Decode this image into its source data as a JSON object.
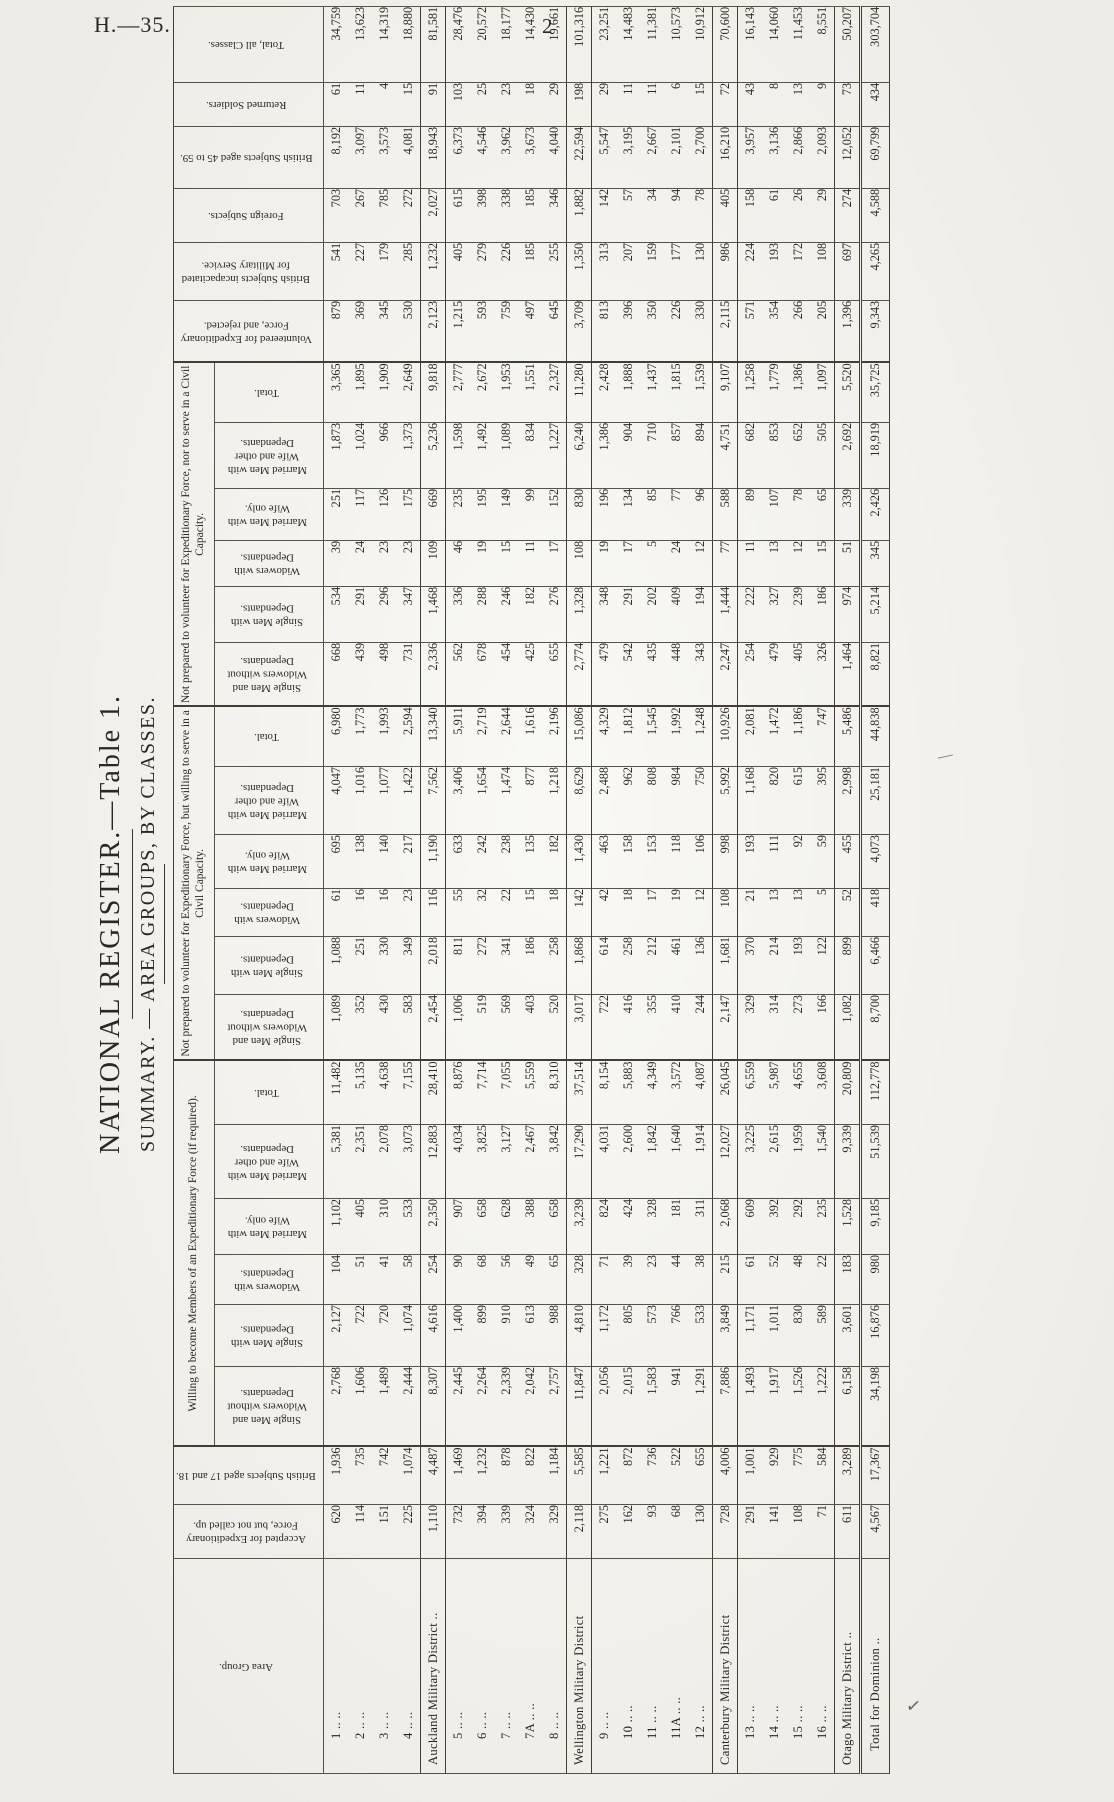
{
  "page": {
    "doc_code": "H.—35.",
    "page_number": "2",
    "ink_marks": [
      "—",
      "✓"
    ]
  },
  "title": {
    "main": "NATIONAL REGISTER.—Table 1.",
    "sub": "SUMMARY. — AREA GROUPS, BY CLASSES."
  },
  "colors": {
    "paper": "#f6f5f0",
    "ink": "#2b2723"
  },
  "table": {
    "col_headers": {
      "area_group": "Area Group.",
      "accepted": "Accepted for Expedi­tionary Force, but not called up.",
      "aged_17_18": "British Subjects aged 17 and 18.",
      "volunteered_rejected": "Volunteered for Expe­ditionary Force, and rejected.",
      "incapacitated": "British Subjects inca­pacitated for Mili­tary Service.",
      "foreign_subjects": "Foreign Subjects.",
      "aged_45_59": "British Subjects aged 45 to 59.",
      "returned_soldiers": "Returned Soldiers.",
      "total_all_classes": "Total, all Classes."
    },
    "group_headers": [
      "Willing to become Members of an Expeditionary Force (if required).",
      "Not prepared to volunteer for Expeditionary Force, but willing to serve in a Civil Capacity.",
      "Not prepared to volunteer for Expeditionary Force, nor to serve in a Civil Capacity."
    ],
    "sub_headers": [
      "Single Men and Widowers without Dependants.",
      "Single Men with Dependants.",
      "Widowers with Dependants.",
      "Married Men with Wife only.",
      "Married Men with Wife and other Dependants.",
      "Total."
    ],
    "rows": [
      {
        "label": "1 .. ..",
        "type": "area",
        "values": [
          "620",
          "1,936",
          "2,768",
          "2,127",
          "104",
          "1,102",
          "5,381",
          "11,482",
          "1,089",
          "1,088",
          "61",
          "695",
          "4,047",
          "6,980",
          "668",
          "534",
          "39",
          "251",
          "1,873",
          "3,365",
          "879",
          "541",
          "703",
          "8,192",
          "61",
          "34,759"
        ]
      },
      {
        "label": "2 .. ..",
        "type": "area",
        "values": [
          "114",
          "735",
          "1,606",
          "722",
          "51",
          "405",
          "2,351",
          "5,135",
          "352",
          "251",
          "16",
          "138",
          "1,016",
          "1,773",
          "439",
          "291",
          "24",
          "117",
          "1,024",
          "1,895",
          "369",
          "227",
          "267",
          "3,097",
          "11",
          "13,623"
        ]
      },
      {
        "label": "3 .. ..",
        "type": "area",
        "values": [
          "151",
          "742",
          "1,489",
          "720",
          "41",
          "310",
          "2,078",
          "4,638",
          "430",
          "330",
          "16",
          "140",
          "1,077",
          "1,993",
          "498",
          "296",
          "23",
          "126",
          "966",
          "1,909",
          "345",
          "179",
          "785",
          "3,573",
          "4",
          "14,319"
        ]
      },
      {
        "label": "4 .. ..",
        "type": "area",
        "values": [
          "225",
          "1,074",
          "2,444",
          "1,074",
          "58",
          "533",
          "3,073",
          "7,155",
          "583",
          "349",
          "23",
          "217",
          "1,422",
          "2,594",
          "731",
          "347",
          "23",
          "175",
          "1,373",
          "2,649",
          "530",
          "285",
          "272",
          "4,081",
          "15",
          "18,880"
        ]
      },
      {
        "label": "Auckland Military District ..",
        "type": "district",
        "values": [
          "1,110",
          "4,487",
          "8,307",
          "4,616",
          "254",
          "2,350",
          "12,883",
          "28,410",
          "2,454",
          "2,018",
          "116",
          "1,190",
          "7,562",
          "13,340",
          "2,336",
          "1,468",
          "109",
          "669",
          "5,236",
          "9,818",
          "2,123",
          "1,232",
          "2,027",
          "18,943",
          "91",
          "81,581"
        ]
      },
      {
        "label": "5 .. ..",
        "type": "area",
        "values": [
          "732",
          "1,469",
          "2,445",
          "1,400",
          "90",
          "907",
          "4,034",
          "8,876",
          "1,006",
          "811",
          "55",
          "633",
          "3,406",
          "5,911",
          "562",
          "336",
          "46",
          "235",
          "1,598",
          "2,777",
          "1,215",
          "405",
          "615",
          "6,373",
          "103",
          "28,476"
        ]
      },
      {
        "label": "6 .. ..",
        "type": "area",
        "values": [
          "394",
          "1,232",
          "2,264",
          "899",
          "68",
          "658",
          "3,825",
          "7,714",
          "519",
          "272",
          "32",
          "242",
          "1,654",
          "2,719",
          "678",
          "288",
          "19",
          "195",
          "1,492",
          "2,672",
          "593",
          "279",
          "398",
          "4,546",
          "25",
          "20,572"
        ]
      },
      {
        "label": "7 .. ..",
        "type": "area",
        "values": [
          "339",
          "878",
          "2,339",
          "910",
          "56",
          "628",
          "3,127",
          "7,055",
          "569",
          "341",
          "22",
          "238",
          "1,474",
          "2,644",
          "454",
          "246",
          "15",
          "149",
          "1,089",
          "1,953",
          "759",
          "226",
          "338",
          "3,962",
          "23",
          "18,177"
        ]
      },
      {
        "label": "7A .. ..",
        "type": "area",
        "values": [
          "324",
          "822",
          "2,042",
          "613",
          "49",
          "388",
          "2,467",
          "5,559",
          "403",
          "186",
          "15",
          "135",
          "877",
          "1,616",
          "425",
          "182",
          "11",
          "99",
          "834",
          "1,551",
          "497",
          "185",
          "185",
          "3,673",
          "18",
          "14,430"
        ]
      },
      {
        "label": "8 .. ..",
        "type": "area",
        "values": [
          "329",
          "1,184",
          "2,757",
          "988",
          "65",
          "658",
          "3,842",
          "8,310",
          "520",
          "258",
          "18",
          "182",
          "1,218",
          "2,196",
          "655",
          "276",
          "17",
          "152",
          "1,227",
          "2,327",
          "645",
          "255",
          "346",
          "4,040",
          "29",
          "19,661"
        ]
      },
      {
        "label": "Wellington Military District",
        "type": "district",
        "values": [
          "2,118",
          "5,585",
          "11,847",
          "4,810",
          "328",
          "3,239",
          "17,290",
          "37,514",
          "3,017",
          "1,868",
          "142",
          "1,430",
          "8,629",
          "15,086",
          "2,774",
          "1,328",
          "108",
          "830",
          "6,240",
          "11,280",
          "3,709",
          "1,350",
          "1,882",
          "22,594",
          "198",
          "101,316"
        ]
      },
      {
        "label": "9 .. ..",
        "type": "area",
        "values": [
          "275",
          "1,221",
          "2,056",
          "1,172",
          "71",
          "824",
          "4,031",
          "8,154",
          "722",
          "614",
          "42",
          "463",
          "2,488",
          "4,329",
          "479",
          "348",
          "19",
          "196",
          "1,386",
          "2,428",
          "813",
          "313",
          "142",
          "5,547",
          "29",
          "23,251"
        ]
      },
      {
        "label": "10 .. ..",
        "type": "area",
        "values": [
          "162",
          "872",
          "2,015",
          "805",
          "39",
          "424",
          "2,600",
          "5,883",
          "416",
          "258",
          "18",
          "158",
          "962",
          "1,812",
          "542",
          "291",
          "17",
          "134",
          "904",
          "1,888",
          "396",
          "207",
          "57",
          "3,195",
          "11",
          "14,483"
        ]
      },
      {
        "label": "11 .. ..",
        "type": "area",
        "values": [
          "93",
          "736",
          "1,583",
          "573",
          "23",
          "328",
          "1,842",
          "4,349",
          "355",
          "212",
          "17",
          "153",
          "808",
          "1,545",
          "435",
          "202",
          "5",
          "85",
          "710",
          "1,437",
          "350",
          "159",
          "34",
          "2,667",
          "11",
          "11,381"
        ]
      },
      {
        "label": "11A .. ..",
        "type": "area",
        "values": [
          "68",
          "522",
          "941",
          "766",
          "44",
          "181",
          "1,640",
          "3,572",
          "410",
          "461",
          "19",
          "118",
          "984",
          "1,992",
          "448",
          "409",
          "24",
          "77",
          "857",
          "1,815",
          "226",
          "177",
          "94",
          "2,101",
          "6",
          "10,573"
        ]
      },
      {
        "label": "12 .. ..",
        "type": "area",
        "values": [
          "130",
          "655",
          "1,291",
          "533",
          "38",
          "311",
          "1,914",
          "4,087",
          "244",
          "136",
          "12",
          "106",
          "750",
          "1,248",
          "343",
          "194",
          "12",
          "96",
          "894",
          "1,539",
          "330",
          "130",
          "78",
          "2,700",
          "15",
          "10,912"
        ]
      },
      {
        "label": "Canterbury Military District",
        "type": "district",
        "values": [
          "728",
          "4,006",
          "7,886",
          "3,849",
          "215",
          "2,068",
          "12,027",
          "26,045",
          "2,147",
          "1,681",
          "108",
          "998",
          "5,992",
          "10,926",
          "2,247",
          "1,444",
          "77",
          "588",
          "4,751",
          "9,107",
          "2,115",
          "986",
          "405",
          "16,210",
          "72",
          "70,600"
        ]
      },
      {
        "label": "13 .. ..",
        "type": "area",
        "values": [
          "291",
          "1,001",
          "1,493",
          "1,171",
          "61",
          "609",
          "3,225",
          "6,559",
          "329",
          "370",
          "21",
          "193",
          "1,168",
          "2,081",
          "254",
          "222",
          "11",
          "89",
          "682",
          "1,258",
          "571",
          "224",
          "158",
          "3,957",
          "43",
          "16,143"
        ]
      },
      {
        "label": "14 .. ..",
        "type": "area",
        "values": [
          "141",
          "929",
          "1,917",
          "1,011",
          "52",
          "392",
          "2,615",
          "5,987",
          "314",
          "214",
          "13",
          "111",
          "820",
          "1,472",
          "479",
          "327",
          "13",
          "107",
          "853",
          "1,779",
          "354",
          "193",
          "61",
          "3,136",
          "8",
          "14,060"
        ]
      },
      {
        "label": "15 .. ..",
        "type": "area",
        "values": [
          "108",
          "775",
          "1,526",
          "830",
          "48",
          "292",
          "1,959",
          "4,655",
          "273",
          "193",
          "13",
          "92",
          "615",
          "1,186",
          "405",
          "239",
          "12",
          "78",
          "652",
          "1,386",
          "266",
          "172",
          "26",
          "2,866",
          "13",
          "11,453"
        ]
      },
      {
        "label": "16 .. ..",
        "type": "area",
        "values": [
          "71",
          "584",
          "1,222",
          "589",
          "22",
          "235",
          "1,540",
          "3,608",
          "166",
          "122",
          "5",
          "59",
          "395",
          "747",
          "326",
          "186",
          "15",
          "65",
          "505",
          "1,097",
          "205",
          "108",
          "29",
          "2,093",
          "9",
          "8,551"
        ]
      },
      {
        "label": "Otago Military District ..",
        "type": "district",
        "values": [
          "611",
          "3,289",
          "6,158",
          "3,601",
          "183",
          "1,528",
          "9,339",
          "20,809",
          "1,082",
          "899",
          "52",
          "455",
          "2,998",
          "5,486",
          "1,464",
          "974",
          "51",
          "339",
          "2,692",
          "5,520",
          "1,396",
          "697",
          "274",
          "12,052",
          "73",
          "50,207"
        ]
      },
      {
        "label": "Total for Dominion ..",
        "type": "grand",
        "values": [
          "4,567",
          "17,367",
          "34,198",
          "16,876",
          "980",
          "9,185",
          "51,539",
          "112,778",
          "8,700",
          "6,466",
          "418",
          "4,073",
          "25,181",
          "44,838",
          "8,821",
          "5,214",
          "345",
          "2,426",
          "18,919",
          "35,725",
          "9,343",
          "4,265",
          "4,588",
          "69,799",
          "434",
          "303,704"
        ]
      }
    ]
  }
}
